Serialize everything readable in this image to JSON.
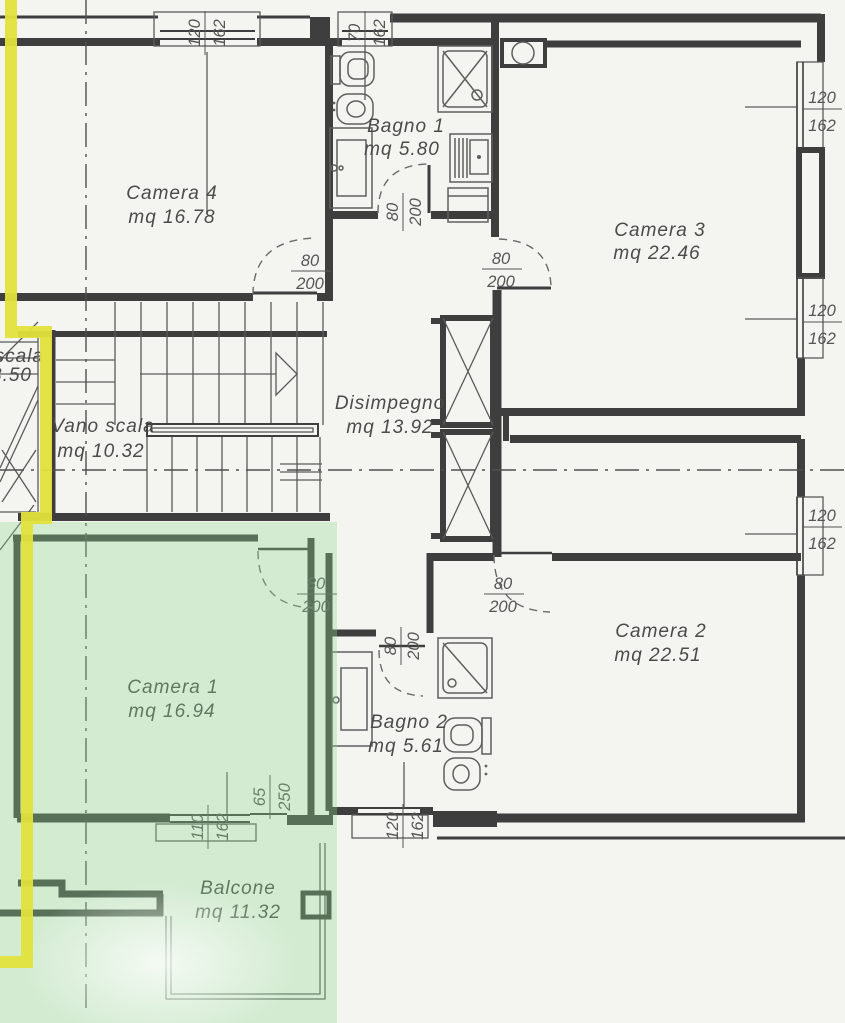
{
  "plan_title": "floor-plan",
  "rooms": {
    "camera4": {
      "name": "Camera 4",
      "area": "mq 16.78"
    },
    "bagno1": {
      "name": "Bagno 1",
      "area": "mq 5.80"
    },
    "camera3": {
      "name": "Camera 3",
      "area": "mq 22.46"
    },
    "vano_scala": {
      "name": "Vano scala",
      "area": "mq 10.32"
    },
    "disimpegno": {
      "name": "Disimpegno",
      "area": "mq 13.92"
    },
    "camera1": {
      "name": "Camera 1",
      "area": "mq 16.94"
    },
    "bagno2": {
      "name": "Bagno 2",
      "area": "mq 5.61"
    },
    "camera2": {
      "name": "Camera 2",
      "area": "mq 22.51"
    },
    "balcone": {
      "name": "Balcone",
      "area": "mq 11.32"
    }
  },
  "cut_label": {
    "line1": "scala",
    "line2": "3.50"
  },
  "doors": {
    "camera4": {
      "w": "80",
      "h": "200"
    },
    "bagno1": {
      "w": "80",
      "h": "200"
    },
    "camera3": {
      "w": "80",
      "h": "200"
    },
    "camera1": {
      "w": "80",
      "h": "200"
    },
    "camera2": {
      "w": "80",
      "h": "200"
    },
    "bagno2": {
      "w": "80",
      "h": "200"
    }
  },
  "windows": {
    "top_left": {
      "w": "120",
      "h": "162"
    },
    "top_bagno1": {
      "w": "70",
      "h": "162"
    },
    "camera3_upper": {
      "w": "120",
      "h": "162"
    },
    "camera3_lower": {
      "w": "120",
      "h": "162"
    },
    "camera2": {
      "w": "120",
      "h": "162"
    },
    "camera1_main": {
      "w": "110",
      "h": "162"
    },
    "camera1_balcony": {
      "w": "65",
      "h": "250"
    },
    "bagno2": {
      "w": "120",
      "h": "162"
    }
  },
  "colors": {
    "highlight_green": "#90da90",
    "boundary_yellow": "#e2e23c",
    "wall": "#3e3e3e",
    "background": "#f4f4f1"
  }
}
